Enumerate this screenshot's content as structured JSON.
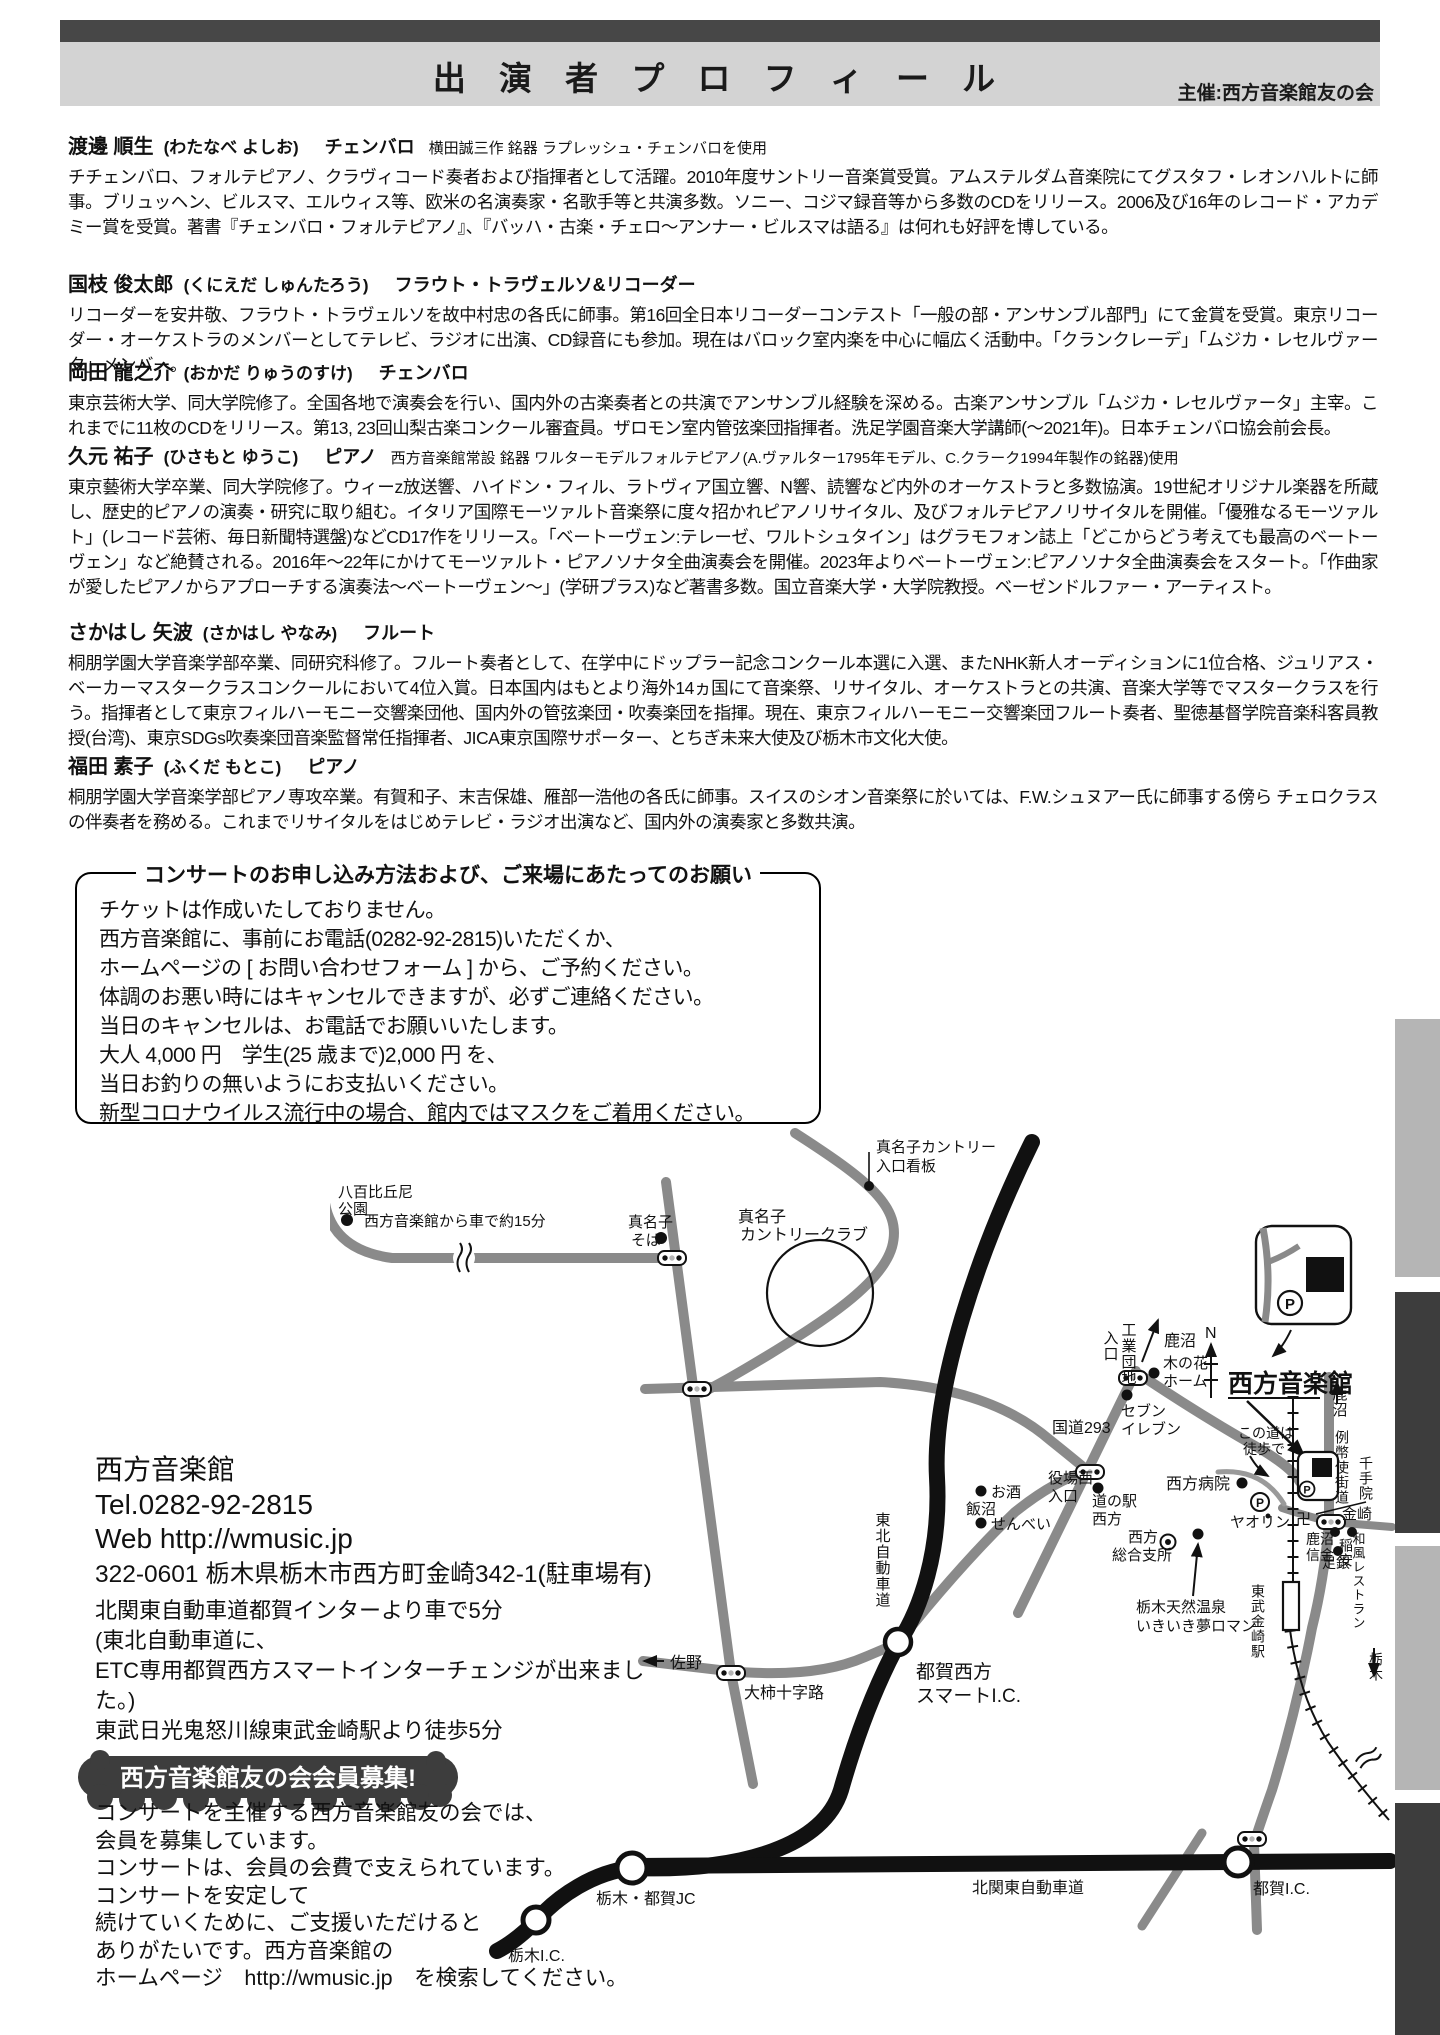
{
  "header": {
    "title": "出 演 者 プ ロ フ ィ ー ル",
    "organizer": "主催:西方音楽館友の会"
  },
  "performers": [
    {
      "name": "渡邊 順生",
      "kana": "(わたなべ よしお)",
      "instrument": "チェンバロ",
      "note": "横田誠三作 銘器 ラプレッシュ・チェンバロを使用",
      "bio": "チチェンバロ、フォルテピアノ、クラヴィコード奏者および指揮者として活躍。2010年度サントリー音楽賞受賞。アムステルダム音楽院にてグスタフ・レオンハルトに師事。ブリュッヘン、ビルスマ、エルウィス等、欧米の名演奏家・名歌手等と共演多数。ソニー、コジマ録音等から多数のCDをリリース。2006及び16年のレコード・アカデミー賞を受賞。著書『チェンバロ・フォルテピアノ』、『バッハ・古楽・チェロ〜アンナー・ビルスマは語る』は何れも好評を博している。"
    },
    {
      "name": "国枝 俊太郎",
      "kana": "(くにえだ しゅんたろう)",
      "instrument": "フラウト・トラヴェルソ&リコーダー",
      "note": "",
      "bio": "リコーダーを安井敬、フラウト・トラヴェルソを故中村忠の各氏に師事。第16回全日本リコーダーコンテスト「一般の部・アンサンブル部門」にて金賞を受賞。東京リコーダー・オーケストラのメンバーとしてテレビ、ラジオに出演、CD録音にも参加。現在はバロック室内楽を中心に幅広く活動中。「クランクレーデ」「ムジカ・レセルヴァータ」メンバー。"
    },
    {
      "name": "岡田 龍之介",
      "kana": "(おかだ りゅうのすけ)",
      "instrument": "チェンバロ",
      "note": "",
      "bio": "東京芸術大学、同大学院修了。全国各地で演奏会を行い、国内外の古楽奏者との共演でアンサンブル経験を深める。古楽アンサンブル「ムジカ・レセルヴァータ」主宰。これまでに11枚のCDをリリース。第13, 23回山梨古楽コンクール審査員。ザロモン室内管弦楽団指揮者。洗足学園音楽大学講師(〜2021年)。日本チェンバロ協会前会長。"
    },
    {
      "name": "久元 祐子",
      "kana": "(ひさもと ゆうこ)",
      "instrument": "ピアノ",
      "note": "西方音楽館常設 銘器 ワルターモデルフォルテピアノ(A.ヴァルター1795年モデル、C.クラーク1994年製作の銘器)使用",
      "bio": "東京藝術大学卒業、同大学院修了。ウィーz放送響、ハイドン・フィル、ラトヴィア国立響、N響、読響など内外のオーケストラと多数協演。19世紀オリジナル楽器を所蔵し、歴史的ピアノの演奏・研究に取り組む。イタリア国際モーツァルト音楽祭に度々招かれピアノリサイタル、及びフォルテピアノリサイタルを開催。「優雅なるモーツァルト」(レコード芸術、毎日新聞特選盤)などCD17作をリリース。「ベートーヴェン:テレーゼ、ワルトシュタイン」はグラモフォン誌上「どこからどう考えても最高のベートーヴェン」など絶賛される。2016年〜22年にかけてモーツァルト・ピアノソナタ全曲演奏会を開催。2023年よりベートーヴェン:ピアノソナタ全曲演奏会をスタート。「作曲家が愛したピアノからアプローチする演奏法〜ベートーヴェン〜」(学研プラス)など著書多数。国立音楽大学・大学院教授。ベーゼンドルファー・アーティスト。"
    },
    {
      "name": "さかはし 矢波",
      "kana": "(さかはし やなみ)",
      "instrument": "フルート",
      "note": "",
      "bio": "桐朋学園大学音楽学部卒業、同研究科修了。フルート奏者として、在学中にドップラー記念コンクール本選に入選、またNHK新人オーディションに1位合格、ジュリアス・ベーカーマスタークラスコンクールにおいて4位入賞。日本国内はもとより海外14ヵ国にて音楽祭、リサイタル、オーケストラとの共演、音楽大学等でマスタークラスを行う。指揮者として東京フィルハーモニー交響楽団他、国内外の管弦楽団・吹奏楽団を指揮。現在、東京フィルハーモニー交響楽団フルート奏者、聖徳基督学院音楽科客員教授(台湾)、東京SDGs吹奏楽団音楽監督常任指揮者、JICA東京国際サポーター、とちぎ未来大使及び栃木市文化大使。"
    },
    {
      "name": "福田 素子",
      "kana": "(ふくだ もとこ)",
      "instrument": "ピアノ",
      "note": "",
      "bio": "桐朋学園大学音楽学部ピアノ専攻卒業。有賀和子、末吉保雄、雁部一浩他の各氏に師事。スイスのシオン音楽祭に於いては、F.W.シュヌアー氏に師事する傍ら チェロクラスの伴奏者を務める。これまでリサイタルをはじめテレビ・ラジオ出演など、国内外の演奏家と多数共演。"
    }
  ],
  "booking": {
    "title": "コンサートのお申し込み方法および、ご来場にあたってのお願い",
    "lines": [
      "チケットは作成いたしておりません。",
      "西方音楽館に、事前にお電話(0282-92-2815)いただくか、",
      "ホームページの [ お問い合わせフォーム ] から、ご予約ください。",
      "体調のお悪い時にはキャンセルできますが、必ずご連絡ください。",
      "当日のキャンセルは、お電話でお願いいたします。",
      "大人 4,000 円　学生(25 歳まで)2,000 円 を、",
      "当日お釣りの無いようにお支払いください。",
      "新型コロナウイルス流行中の場合、館内ではマスクをご着用ください。"
    ]
  },
  "venue": {
    "name": "西方音楽館",
    "tel": "Tel.0282-92-2815",
    "web": "Web http://wmusic.jp",
    "address": "322-0601 栃木県栃木市西方町金崎342-1(駐車場有)",
    "access": [
      "北関東自動車道都賀インターより車で5分",
      "(東北自動車道に、",
      "ETC専用都賀西方スマートインターチェンジが出来ました。)",
      "東武日光鬼怒川線東武金崎駅より徒歩5分"
    ]
  },
  "membership": {
    "badge": "西方音楽館友の会会員募集!",
    "lines": [
      "コンサートを主催する西方音楽館友の会では、",
      "会員を募集しています。",
      "コンサートは、会員の会費で支えられています。",
      "コンサートを安定して",
      "続けていくために、ご支援いただけると",
      "ありがたいです。西方音楽館の",
      "ホームページ　http://wmusic.jp　を検索してください。"
    ]
  },
  "map": {
    "labels": {
      "yaho1": "八百比丘尼",
      "yaho2": "公園",
      "drive15": "西方音楽館から車で約15分",
      "soba1": "真名子",
      "soba2": "そば",
      "cc1": "真名子",
      "cc2": "カントリークラブ",
      "kanban1": "真名子カントリー",
      "kanban2": "入口看板",
      "kogyo": "工業団地",
      "iriguchi": "入口",
      "kanuma_top": "鹿沼",
      "n": "N",
      "konohana1": "木の花",
      "konohana2": "ホーム",
      "seven1": "セブン",
      "seven2": "イレブン",
      "r293": "国道293",
      "onkan": "西方音楽館",
      "konomichi1": "この道は",
      "konomichi2": "徒歩で",
      "byoin": "西方病院",
      "yaorin": "ヤオリン",
      "yakuba1": "役場西",
      "yakuba2": "入口",
      "michinoeki1": "道の駅",
      "michinoeki2": "西方",
      "shisho1": "西方",
      "shisho2": "総合支所",
      "onsen1": "栃木天然温泉",
      "onsen2": "いきいき夢ロマン",
      "osake": "お酒",
      "iinuma": "飯沼",
      "senbei": "せんべい",
      "tohoku_exp": "東北自動車道",
      "smart1": "都賀西方",
      "smart2": "スマートI.C.",
      "sano": "佐野",
      "ogaki": "大柿十字路",
      "tochigi_ic": "栃木I.C.",
      "jc": "栃木・都賀JC",
      "kitakanto": "北関東自動車道",
      "tsuga_ic": "都賀I.C.",
      "tobu_st": "東武金崎駅",
      "reiheishi": "例幣使街道",
      "senjuin": "千手院",
      "manji": "卍",
      "kanasaki": "金崎",
      "shinkin1": "鹿沼",
      "shinkin2": "信金",
      "inayasu": "稲安",
      "wafu": "和風レストラン",
      "ashigin": "足銀",
      "kanuma_right": "鹿沼",
      "tochigi_down": "栃木",
      "p": "P"
    }
  }
}
